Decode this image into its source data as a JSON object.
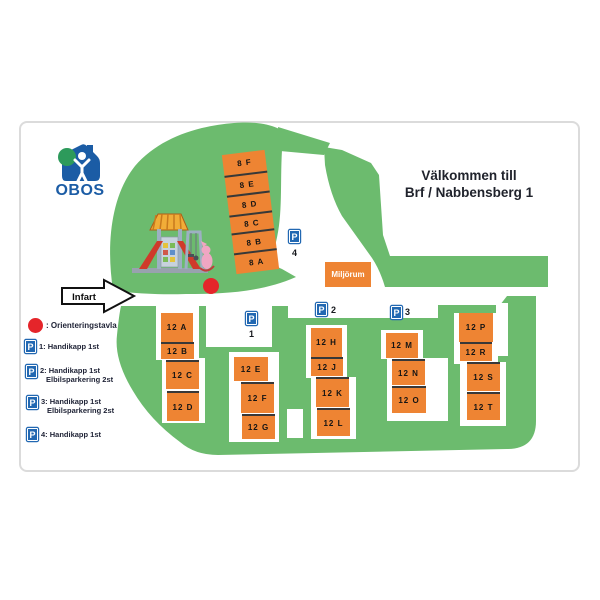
{
  "brand": {
    "name": "OBOS"
  },
  "title": {
    "line1": "Välkommen till",
    "line2": "Brf / Nabbensberg 1"
  },
  "entrance": {
    "label": "Infart"
  },
  "facilities": {
    "miljorum": "Miljörum"
  },
  "buildings": {
    "b8": [
      "8 F",
      "8 E",
      "8 D",
      "8 C",
      "8 B",
      "8 A"
    ],
    "b12c1": [
      "12 A",
      "12 B",
      "12 C",
      "12 D"
    ],
    "b12c2": [
      "12 E",
      "12 F",
      "12 G"
    ],
    "b12c3": [
      "12 H",
      "12 J",
      "12 K",
      "12 L"
    ],
    "b12c4": [
      "12 M",
      "12 N",
      "12 O"
    ],
    "b12c5": [
      "12 P",
      "12 R",
      "12 S",
      "12 T"
    ]
  },
  "parking": {
    "p1": {
      "letter": "P",
      "number": "1"
    },
    "p2": {
      "letter": "P",
      "number": "2"
    },
    "p3": {
      "letter": "P",
      "number": "3"
    },
    "p4": {
      "letter": "P",
      "number": "4"
    }
  },
  "legend": {
    "orientation_label": ": Orienteringstavla",
    "items": [
      {
        "letter": "P",
        "line1": "1: Handikapp 1st",
        "line2": ""
      },
      {
        "letter": "P",
        "line1": "2: Handikapp 1st",
        "line2": "Elbilsparkering 2st"
      },
      {
        "letter": "P",
        "line1": "3: Handikapp 1st",
        "line2": "Elbilsparkering 2st"
      },
      {
        "letter": "P",
        "line1": "4: Handikapp 1st",
        "line2": ""
      }
    ]
  },
  "colors": {
    "map_green": "#6cbb6e",
    "building_orange": "#ee8433",
    "parking_blue": "#2268b2",
    "obos_blue": "#1b5ca5",
    "marker_red": "#e5252a"
  }
}
